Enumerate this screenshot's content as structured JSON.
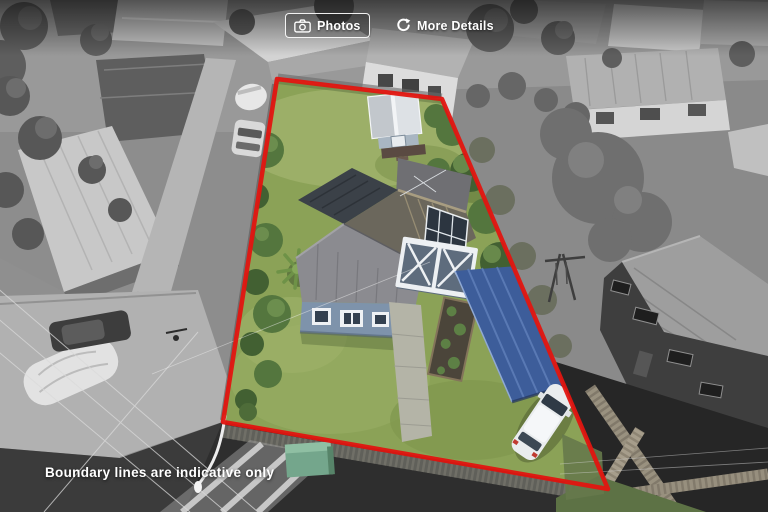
{
  "top_bar": {
    "photos_button": {
      "label": "Photos",
      "icon": "camera-icon"
    },
    "more_details_button": {
      "label": "More Details",
      "icon": "refresh-icon"
    }
  },
  "boundary": {
    "points": "277,79 442,99 608,489 223,422"
  },
  "footer": {
    "disclaimer": "Boundary lines are indicative only"
  },
  "palette": {
    "boundary_red": "#e11510",
    "lawn": "#8ba257",
    "lawn_light": "#9fb26b",
    "tree": "#54763e",
    "tree_dark": "#426032",
    "house_wall": "#7e93ab",
    "roof_dark": "#3b4148",
    "roof_main": "#6b675c",
    "roof_front": "#8b8b90",
    "carport_blue": "#3d5d9a",
    "shed_roof": "#dde1e5",
    "path_concrete": "#b4b4a7",
    "utility_box": "#74a68c",
    "suv_white": "#e9ecee"
  }
}
